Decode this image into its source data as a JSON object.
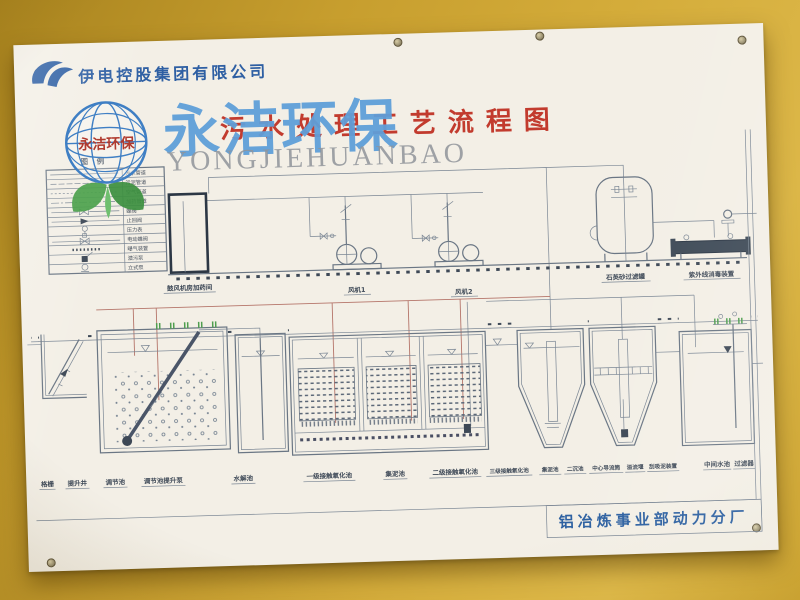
{
  "header": {
    "company": "伊电控股集团有限公司"
  },
  "title": "污水处理工艺流程图",
  "watermark": {
    "cn": "永洁环保",
    "en": "YONGJIEHUANBAO",
    "globe_text": "永洁环保"
  },
  "legend": {
    "title": "图 例",
    "items": [
      {
        "symbol": "solid-line",
        "label": "污水管道"
      },
      {
        "symbol": "dashed-line",
        "label": "污泥管道"
      },
      {
        "symbol": "dotted-line",
        "label": "空气管道"
      },
      {
        "symbol": "dash-dot-line",
        "label": "加药管道"
      },
      {
        "symbol": "butterfly-valve",
        "label": "蝶阀"
      },
      {
        "symbol": "check-valve",
        "label": "止回阀"
      },
      {
        "symbol": "pressure-gauge",
        "label": "压力表"
      },
      {
        "symbol": "electric-valve",
        "label": "电动蝶阀"
      },
      {
        "symbol": "aerator",
        "label": "曝气装置"
      },
      {
        "symbol": "submersible-pump",
        "label": "潜污泵"
      },
      {
        "symbol": "vertical-pump",
        "label": "立式泵"
      }
    ]
  },
  "equipment": {
    "blower_room": "鼓风机房加药间",
    "fan1": "风机1",
    "fan2": "风机2",
    "filter_tank": "石英砂过滤罐",
    "uv_unit": "紫外线消毒装置"
  },
  "tanks": [
    {
      "label": "格栅"
    },
    {
      "label": "提升井"
    },
    {
      "label": "调节池"
    },
    {
      "label": "调节池提升泵"
    },
    {
      "label": "水解池"
    },
    {
      "label": "一级接触氧化池"
    },
    {
      "label": "集泥池"
    },
    {
      "label": "二级接触氧化池"
    },
    {
      "label": "三级接触氧化池"
    },
    {
      "label": "集泥池"
    },
    {
      "label": "二沉池"
    },
    {
      "label": "中心导流筒"
    },
    {
      "label": "溢流堰"
    },
    {
      "label": "刮吸泥装置"
    },
    {
      "label": "中间水池"
    },
    {
      "label": "过滤器"
    }
  ],
  "footer": {
    "plant": "铝冶炼事业部动力分厂"
  },
  "colors": {
    "wall": "#cda535",
    "title_red": "#c23b2e",
    "company_blue": "#2e5fa3",
    "watermark_blue": "#5f9fd9",
    "footer_blue": "#2b5fa0",
    "diagram_line": "#6a7684",
    "pipe_red": "#b5756a",
    "aerator_green": "#4f9e4f"
  }
}
